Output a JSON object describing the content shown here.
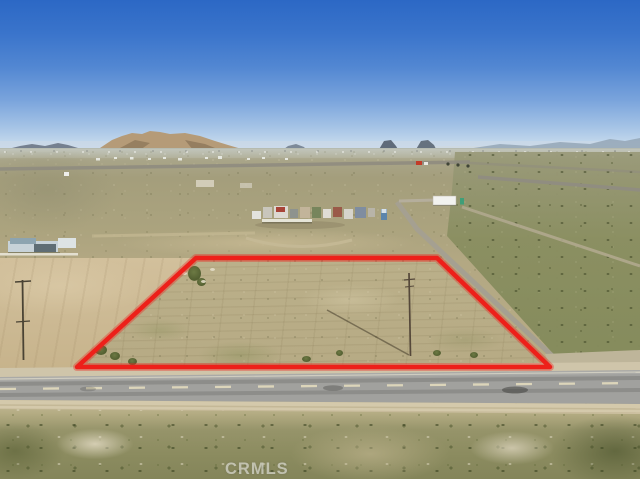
{
  "photo": {
    "watermark_text": "CRMLS",
    "description": "Aerial drone photo of a vacant desert land parcel outlined in red, bordered by a paved two-lane road, with a graded dirt field, scattered rural structures, desert scrub, mountains and blue sky at the horizon"
  },
  "annotation": {
    "boundary_color": "#ED201A",
    "boundary_points": "196,258 437,258 550,367 77,367"
  },
  "palette": {
    "sky_top": "#2C68C5",
    "sky_horizon": "#CFDFEE",
    "desert_tan": "#B3A881",
    "dirt_field_tan": "#D0BE9A",
    "scrub_green": "#8C9164",
    "road_gray": "#A1A19E",
    "mountain_tan": "#B59B78"
  }
}
